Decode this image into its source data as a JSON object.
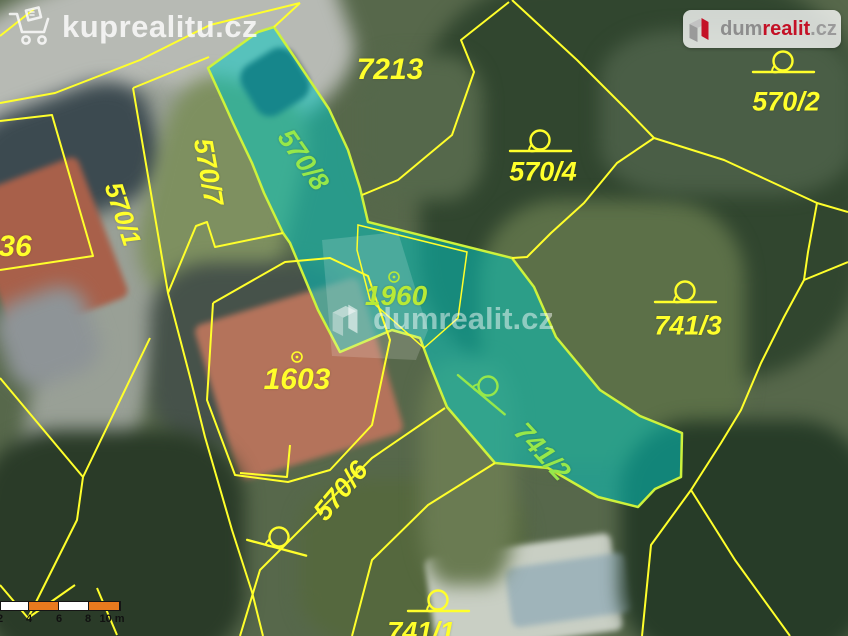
{
  "branding": {
    "kuprealitu": {
      "label": "kuprealitu.cz"
    },
    "dumrealit": {
      "part1": "dum",
      "part2": "realit",
      "part3": ".cz"
    },
    "watermark": {
      "label": "dumrealit.cz"
    }
  },
  "map": {
    "colors": {
      "boundary": "#ffff2b",
      "highlight_fill": "#00c9c4",
      "highlight_stroke": "#cdf23c",
      "label_yellow": "#ffff2b",
      "label_green": "#96e84a",
      "label_lime": "#b8ea36",
      "scale_orange": "#e87a1e",
      "scale_white": "#ffffff"
    },
    "parcel_labels": [
      {
        "text": "7213",
        "x": 390,
        "y": 70,
        "rot": 0,
        "size": 30,
        "color": "yellow"
      },
      {
        "text": "570/2",
        "x": 786,
        "y": 102,
        "rot": 0,
        "size": 27,
        "color": "yellow"
      },
      {
        "text": "570/4",
        "x": 543,
        "y": 172,
        "rot": 0,
        "size": 27,
        "color": "yellow"
      },
      {
        "text": "570/7",
        "x": 208,
        "y": 172,
        "rot": 80,
        "size": 27,
        "color": "yellow"
      },
      {
        "text": "570/8",
        "x": 303,
        "y": 160,
        "rot": 55,
        "size": 27,
        "color": "green"
      },
      {
        "text": "570/1",
        "x": 123,
        "y": 214,
        "rot": 72,
        "size": 26,
        "color": "yellow"
      },
      {
        "text": "36",
        "x": 15,
        "y": 247,
        "rot": 0,
        "size": 30,
        "color": "yellow"
      },
      {
        "text": "1960",
        "x": 396,
        "y": 296,
        "rot": 0,
        "size": 28,
        "color": "lime"
      },
      {
        "text": "741/3",
        "x": 688,
        "y": 326,
        "rot": 0,
        "size": 27,
        "color": "yellow"
      },
      {
        "text": "1603",
        "x": 297,
        "y": 380,
        "rot": 0,
        "size": 30,
        "color": "yellow"
      },
      {
        "text": "741/2",
        "x": 542,
        "y": 452,
        "rot": 47,
        "size": 27,
        "color": "green"
      },
      {
        "text": "570/6",
        "x": 341,
        "y": 491,
        "rot": -50,
        "size": 27,
        "color": "yellow"
      },
      {
        "text": "741/1",
        "x": 421,
        "y": 632,
        "rot": 0,
        "size": 27,
        "color": "yellow"
      }
    ],
    "symbols": [
      {
        "kind": "circle-tail",
        "x": 783,
        "y": 61,
        "rot": 0,
        "color": "yellow"
      },
      {
        "kind": "circle-tail",
        "x": 540,
        "y": 140,
        "rot": 0,
        "color": "yellow"
      },
      {
        "kind": "circle-tail",
        "x": 685,
        "y": 291,
        "rot": 0,
        "color": "yellow"
      },
      {
        "kind": "circle-tail",
        "x": 488,
        "y": 386,
        "rot": 40,
        "color": "green"
      },
      {
        "kind": "circle-tail",
        "x": 279,
        "y": 537,
        "rot": 15,
        "color": "yellow"
      },
      {
        "kind": "circle-tail",
        "x": 438,
        "y": 600,
        "rot": 0,
        "color": "yellow"
      },
      {
        "kind": "dot",
        "x": 297,
        "y": 357,
        "rot": 0,
        "color": "yellow"
      },
      {
        "kind": "dot",
        "x": 394,
        "y": 277,
        "rot": 0,
        "color": "lime"
      }
    ],
    "boundary_lines": [
      {
        "points": [
          [
            300,
            3
          ],
          [
            210,
            25
          ],
          [
            140,
            60
          ],
          [
            55,
            93
          ],
          [
            0,
            103
          ]
        ]
      },
      {
        "points": [
          [
            0,
            36
          ],
          [
            34,
            9
          ]
        ]
      },
      {
        "points": [
          [
            0,
            121
          ],
          [
            52,
            115
          ],
          [
            93,
            256
          ],
          [
            40,
            264
          ],
          [
            0,
            270
          ]
        ]
      },
      {
        "points": [
          [
            133,
            88
          ],
          [
            209,
            57
          ]
        ]
      },
      {
        "points": [
          [
            133,
            88
          ],
          [
            168,
            293
          ],
          [
            190,
            377
          ],
          [
            205,
            437
          ],
          [
            232,
            530
          ],
          [
            252,
            592
          ],
          [
            263,
            636
          ]
        ]
      },
      {
        "points": [
          [
            283,
            233
          ],
          [
            215,
            247
          ],
          [
            207,
            222
          ],
          [
            196,
            226
          ],
          [
            168,
            293
          ]
        ]
      },
      {
        "points": [
          [
            150,
            338
          ],
          [
            83,
            477
          ],
          [
            77,
            520
          ],
          [
            28,
            618
          ]
        ]
      },
      {
        "points": [
          [
            0,
            378
          ],
          [
            83,
            477
          ]
        ]
      },
      {
        "points": [
          [
            0,
            585
          ],
          [
            28,
            618
          ],
          [
            75,
            585
          ]
        ]
      },
      {
        "points": [
          [
            97,
            588
          ],
          [
            117,
            635
          ]
        ]
      },
      {
        "points": [
          [
            213,
            303
          ],
          [
            285,
            262
          ],
          [
            330,
            258
          ],
          [
            368,
            276
          ],
          [
            390,
            340
          ],
          [
            372,
            425
          ],
          [
            330,
            470
          ],
          [
            288,
            482
          ],
          [
            235,
            475
          ],
          [
            207,
            400
          ],
          [
            213,
            303
          ]
        ]
      },
      {
        "points": [
          [
            240,
            473
          ],
          [
            287,
            477
          ],
          [
            290,
            445
          ]
        ]
      },
      {
        "points": [
          [
            445,
            408
          ],
          [
            372,
            458
          ],
          [
            260,
            570
          ],
          [
            240,
            636
          ]
        ]
      },
      {
        "points": [
          [
            495,
            463
          ],
          [
            428,
            505
          ],
          [
            372,
            560
          ],
          [
            352,
            636
          ]
        ]
      },
      {
        "points": [
          [
            512,
            0
          ],
          [
            577,
            60
          ],
          [
            627,
            110
          ],
          [
            654,
            138
          ]
        ]
      },
      {
        "points": [
          [
            654,
            138
          ],
          [
            724,
            160
          ],
          [
            817,
            203
          ],
          [
            848,
            212
          ]
        ]
      },
      {
        "points": [
          [
            509,
            2
          ],
          [
            461,
            40
          ],
          [
            474,
            72
          ],
          [
            452,
            135
          ],
          [
            398,
            180
          ],
          [
            362,
            195
          ]
        ]
      },
      {
        "points": [
          [
            654,
            138
          ],
          [
            617,
            163
          ],
          [
            584,
            203
          ],
          [
            551,
            233
          ],
          [
            527,
            257
          ],
          [
            512,
            258
          ]
        ]
      },
      {
        "points": [
          [
            817,
            203
          ],
          [
            808,
            252
          ],
          [
            804,
            280
          ],
          [
            784,
            317
          ],
          [
            761,
            363
          ],
          [
            741,
            410
          ],
          [
            721,
            443
          ],
          [
            691,
            490
          ],
          [
            651,
            545
          ],
          [
            642,
            636
          ]
        ]
      },
      {
        "points": [
          [
            804,
            280
          ],
          [
            848,
            262
          ]
        ]
      },
      {
        "points": [
          [
            691,
            490
          ],
          [
            735,
            560
          ],
          [
            790,
            636
          ]
        ]
      },
      {
        "points": [
          [
            274,
            27
          ],
          [
            300,
            3
          ]
        ]
      }
    ],
    "highlight_polygon": [
      [
        258,
        32
      ],
      [
        274,
        27
      ],
      [
        295,
        58
      ],
      [
        329,
        109
      ],
      [
        348,
        150
      ],
      [
        360,
        188
      ],
      [
        368,
        222
      ],
      [
        512,
        258
      ],
      [
        534,
        287
      ],
      [
        556,
        337
      ],
      [
        600,
        390
      ],
      [
        640,
        416
      ],
      [
        682,
        433
      ],
      [
        681,
        477
      ],
      [
        655,
        489
      ],
      [
        638,
        507
      ],
      [
        598,
        497
      ],
      [
        548,
        468
      ],
      [
        495,
        463
      ],
      [
        447,
        407
      ],
      [
        430,
        365
      ],
      [
        420,
        338
      ],
      [
        392,
        330
      ],
      [
        340,
        352
      ],
      [
        318,
        310
      ],
      [
        290,
        243
      ],
      [
        283,
        233
      ],
      [
        264,
        193
      ],
      [
        252,
        163
      ],
      [
        233,
        123
      ],
      [
        224,
        103
      ],
      [
        208,
        68
      ]
    ],
    "inner_parcel_outline": [
      [
        358,
        225
      ],
      [
        467,
        252
      ],
      [
        458,
        318
      ],
      [
        424,
        348
      ],
      [
        370,
        300
      ],
      [
        357,
        250
      ]
    ],
    "building_footprint": [
      [
        322,
        240
      ],
      [
        398,
        232
      ],
      [
        428,
        330
      ],
      [
        416,
        360
      ],
      [
        332,
        356
      ]
    ],
    "scale_bar": {
      "segments": [
        {
          "w": 28,
          "c": "white"
        },
        {
          "w": 30,
          "c": "orange"
        },
        {
          "w": 30,
          "c": "white"
        },
        {
          "w": 31,
          "c": "orange"
        }
      ],
      "ticks": [
        {
          "label": "2",
          "x": 0
        },
        {
          "label": "4",
          "x": 29
        },
        {
          "label": "6",
          "x": 59
        },
        {
          "label": "8",
          "x": 88
        },
        {
          "label": "10 m",
          "x": 112
        }
      ]
    }
  }
}
